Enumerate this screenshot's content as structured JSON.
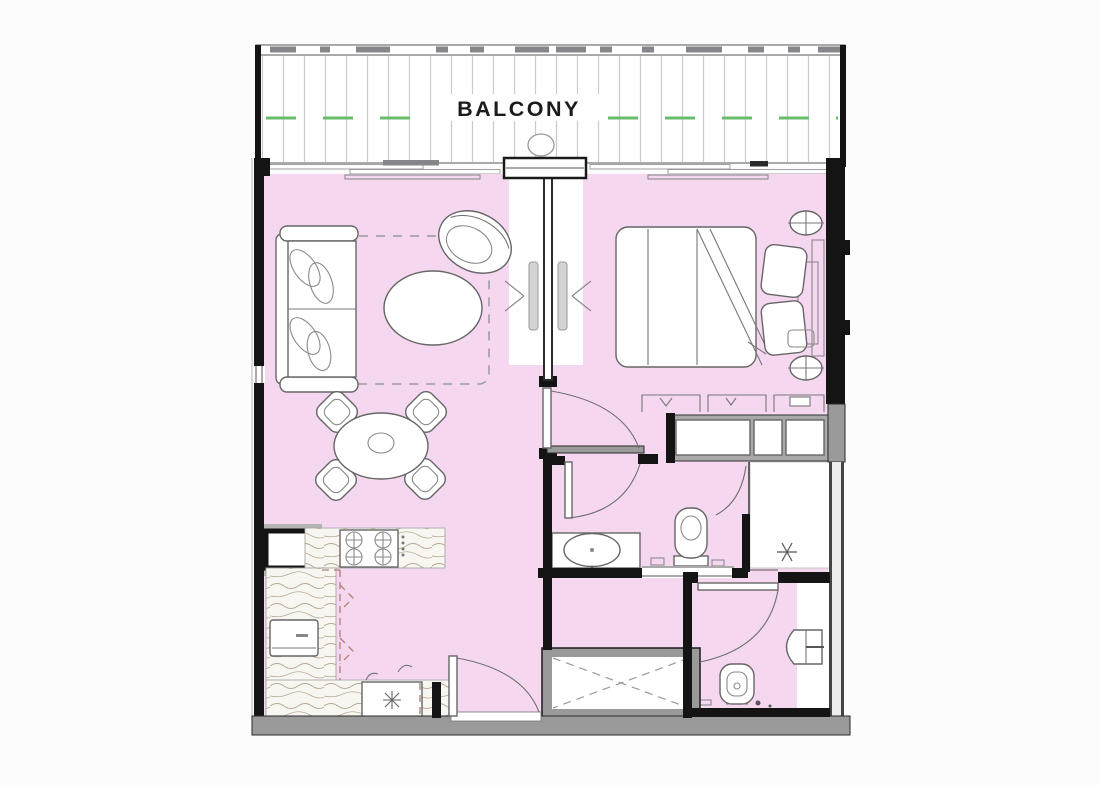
{
  "floor_plan": {
    "type": "apartment-floor-plan",
    "labels": {
      "balcony": "BALCONY"
    },
    "colors": {
      "background": "#fcfcfc",
      "floor_pink": "#f6d7f0",
      "wall_black": "#141414",
      "wall_gray": "#9a9a9a",
      "balcony_green": "#68bd6c",
      "balcony_hatch": "#c9c9ce",
      "wood_base": "#f8f6f1",
      "wood_grain": "#b6a994",
      "cabinet_dash": "#b07f6f",
      "fixture_line": "#666666"
    }
  }
}
